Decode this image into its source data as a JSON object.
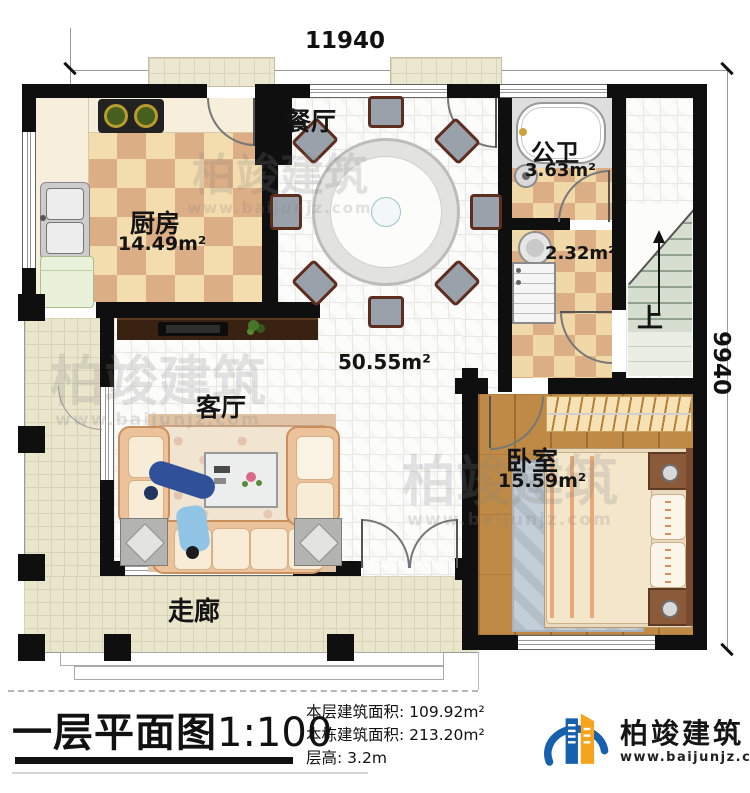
{
  "dimensions": {
    "width_mm": "11940",
    "depth_mm": "9940"
  },
  "rooms": {
    "dining": {
      "name": "餐厅"
    },
    "kitchen": {
      "name": "厨房",
      "area": "14.49m²"
    },
    "public_bath": {
      "name": "公卫",
      "area": "3.63m²"
    },
    "laundry": {
      "area": "2.32m²"
    },
    "hall": {
      "area": "50.55m²"
    },
    "living": {
      "name": "客厅"
    },
    "bedroom": {
      "name": "卧室",
      "area": "15.59m²"
    },
    "corridor": {
      "name": "走廊"
    },
    "stair": {
      "up_label": "上"
    }
  },
  "title_block": {
    "plan_title": "一层平面图",
    "scale": "1:100",
    "stats": [
      {
        "label": "本层建筑面积:",
        "value": "109.92m²"
      },
      {
        "label": "本栋建筑面积:",
        "value": "213.20m²"
      },
      {
        "label": "层高:",
        "value": "3.2m"
      }
    ],
    "brand": {
      "name": "柏竣建筑",
      "website": "www.baijunjz.com"
    }
  },
  "watermark": {
    "text": "柏竣建筑",
    "website": "www.baijunjz.com"
  },
  "colors": {
    "wall": "#0f0f0f",
    "kitchen_tile_light": "#f3dcae",
    "kitchen_tile_dark": "#dcae85",
    "wood_floor": "#bf8a46",
    "veranda_tile": "#eae6cc",
    "stair_tread": "#d5decf",
    "brand_blue": "#1760ae",
    "brand_orange": "#f6a41e"
  }
}
